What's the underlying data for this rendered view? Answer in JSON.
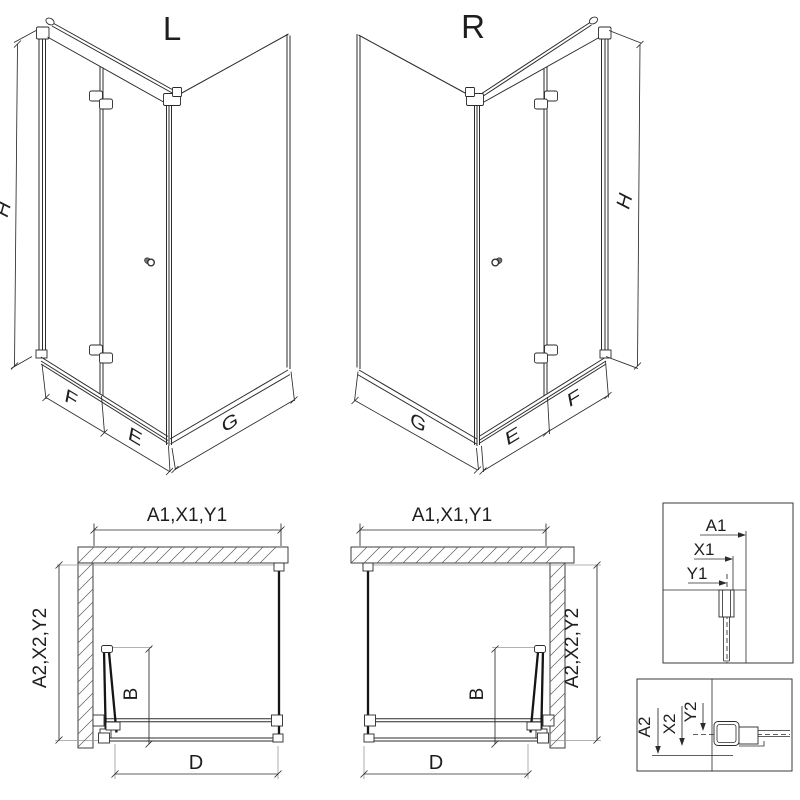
{
  "colors": {
    "line": "#2b2b2b",
    "background": "#ffffff"
  },
  "iso_left": {
    "title": "L",
    "height": "H",
    "door_leaf": "F",
    "door_corner": "E",
    "side_panel": "G"
  },
  "iso_right": {
    "title": "R",
    "height": "H",
    "door_leaf": "F",
    "door_corner": "E",
    "side_panel": "G"
  },
  "plan_left": {
    "width": "A1,X1,Y1",
    "depth": "A2,X2,Y2",
    "fold": "B",
    "entry": "D"
  },
  "plan_right": {
    "width": "A1,X1,Y1",
    "depth": "A2,X2,Y2",
    "fold": "B",
    "entry": "D"
  },
  "detail_width": {
    "labels": [
      "A1",
      "X1",
      "Y1"
    ]
  },
  "detail_depth": {
    "labels": [
      "A2",
      "X2",
      "Y2"
    ]
  }
}
